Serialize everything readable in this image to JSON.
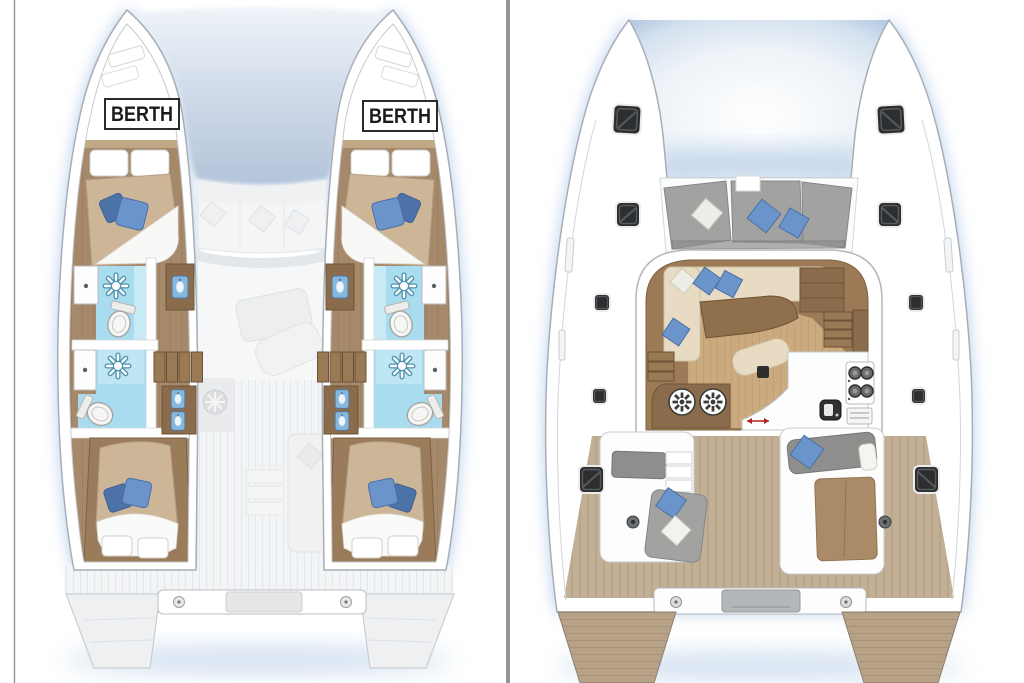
{
  "labels": {
    "berth_port": "BERTH",
    "berth_starboard": "BERTH"
  },
  "colors": {
    "hullStroke": "#a8aeb5",
    "shadowBlue": "#aecbe8",
    "wood": "#a5896a",
    "woodDark": "#8a6c4c",
    "woodStep": "#9a7a55",
    "mattress": "#cdb698",
    "pillowBlue": "#6b94cb",
    "pillowBlueDark": "#4d72a7",
    "bath": "#a9dcee",
    "bathLight": "#cdecf6",
    "teak": "#c2b096",
    "teakLine": "#a3906f",
    "salonBorder": "#9b7a55",
    "salonFloor": "#cbaa80",
    "cream": "#e7dcc3",
    "grayCushion": "#a2a3a1",
    "grayCushionDark": "#8e8f8d",
    "hatch": "#2c2e30",
    "divider": "#94979a"
  },
  "panels": {
    "lower_deck": {
      "side": "left",
      "features": [
        "forward-berth-cabin",
        "bathroom-with-shower",
        "aft-berth-cabin",
        "stairs",
        "vanity-sink",
        "toilet",
        "ghost-salon-furniture"
      ]
    },
    "main_deck": {
      "side": "right",
      "features": [
        "trampoline",
        "foredeck-seating",
        "salon-sofa",
        "salon-table",
        "galley-stove",
        "galley-sink",
        "deck-hatches",
        "aft-cockpit",
        "sunpad",
        "transom-steps"
      ]
    }
  },
  "icons": {
    "shower": "sun-rays",
    "toilet": "oval-bowl",
    "stove": "four-burners",
    "helm_table": "spoked-wheel",
    "hatch": "dark-rounded-square"
  }
}
